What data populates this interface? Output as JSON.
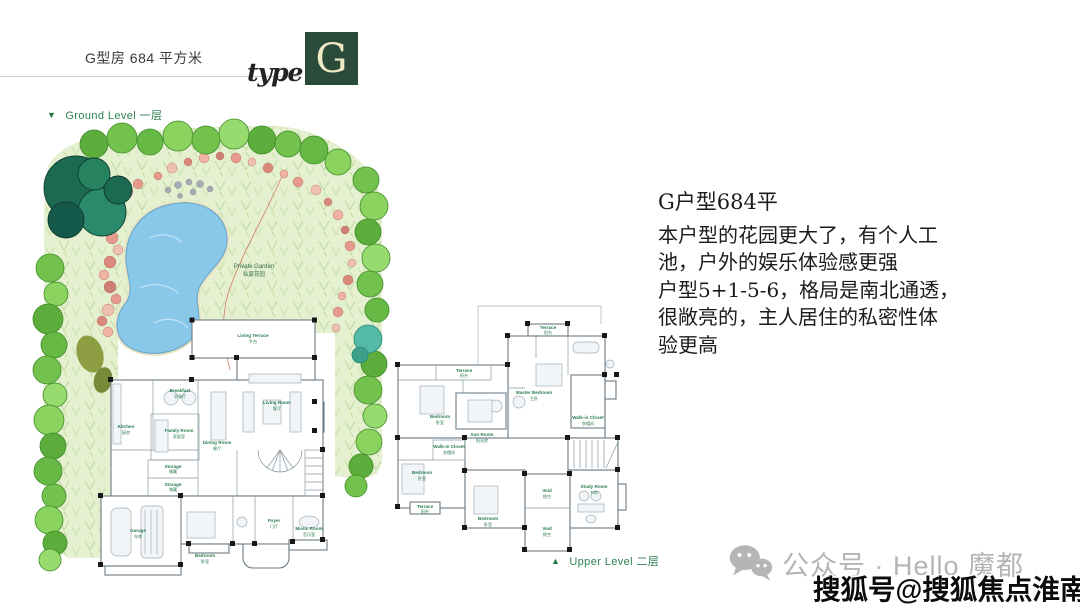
{
  "header": {
    "area_title": "G型房 684 平方米",
    "logo_word": "type",
    "logo_letter": "G"
  },
  "icons": {
    "ground_marker": "▼",
    "upper_marker": "▲"
  },
  "levels": {
    "ground": "Ground Level  一层",
    "upper": "Upper Level  二层"
  },
  "garden": {
    "name_en": "Private Garden",
    "name_zh": "私家花园"
  },
  "floor1": {
    "rooms": [
      {
        "en": "Living Terrace",
        "zh": "平台"
      },
      {
        "en": "Breakfast",
        "zh": "早餐厅"
      },
      {
        "en": "Kitchen",
        "zh": "厨房"
      },
      {
        "en": "Family Room",
        "zh": "家庭室"
      },
      {
        "en": "Dining Room",
        "zh": "餐厅"
      },
      {
        "en": "Living Room",
        "zh": "客厅"
      },
      {
        "en": "Storage",
        "zh": "储藏"
      },
      {
        "en": "Storage",
        "zh": "储藏"
      },
      {
        "en": "Garage",
        "zh": "车库"
      },
      {
        "en": "Bedroom",
        "zh": "卧室"
      },
      {
        "en": "Foyer",
        "zh": "门厅"
      },
      {
        "en": "Music Room",
        "zh": "音乐室"
      }
    ]
  },
  "floor2": {
    "rooms": [
      {
        "en": "Terrace",
        "zh": "阳台"
      },
      {
        "en": "Master Bedroom",
        "zh": "主卧"
      },
      {
        "en": "Terrace",
        "zh": "阳台"
      },
      {
        "en": "Bedroom",
        "zh": "卧室"
      },
      {
        "en": "Sun Room",
        "zh": "阳光房"
      },
      {
        "en": "Walk-in Closet",
        "zh": "衣帽间"
      },
      {
        "en": "Walk-in Closet",
        "zh": "衣帽间"
      },
      {
        "en": "Bedroom",
        "zh": "卧室"
      },
      {
        "en": "Terrace",
        "zh": "阳台"
      },
      {
        "en": "Bedroom",
        "zh": "卧室"
      },
      {
        "en": "Void",
        "zh": "挑空"
      },
      {
        "en": "Void",
        "zh": "挑空"
      },
      {
        "en": "Study Room",
        "zh": "书房"
      }
    ]
  },
  "description": {
    "title": "G户型684平",
    "lines": [
      "本户型的花园更大了，有个人工",
      "池，户外的娱乐体验感更强",
      "户型5+1-5-6，格局是南北通透，",
      "很敞亮的，主人居住的私密性体",
      "验更高"
    ]
  },
  "footer": {
    "wechat_label": "公众号 · Hello 魔都",
    "watermark": "搜狐号@搜狐焦点淮南站"
  },
  "colors": {
    "brand_green": "#2e8153",
    "logo_bg": "#2a4a3a",
    "logo_letter": "#efe9c4",
    "room_label_green": "#2a7c50",
    "pond_blue": "#8ac8ea",
    "lawn_green": "#e5f0d0",
    "footer_gray": "#b5b5b5"
  }
}
